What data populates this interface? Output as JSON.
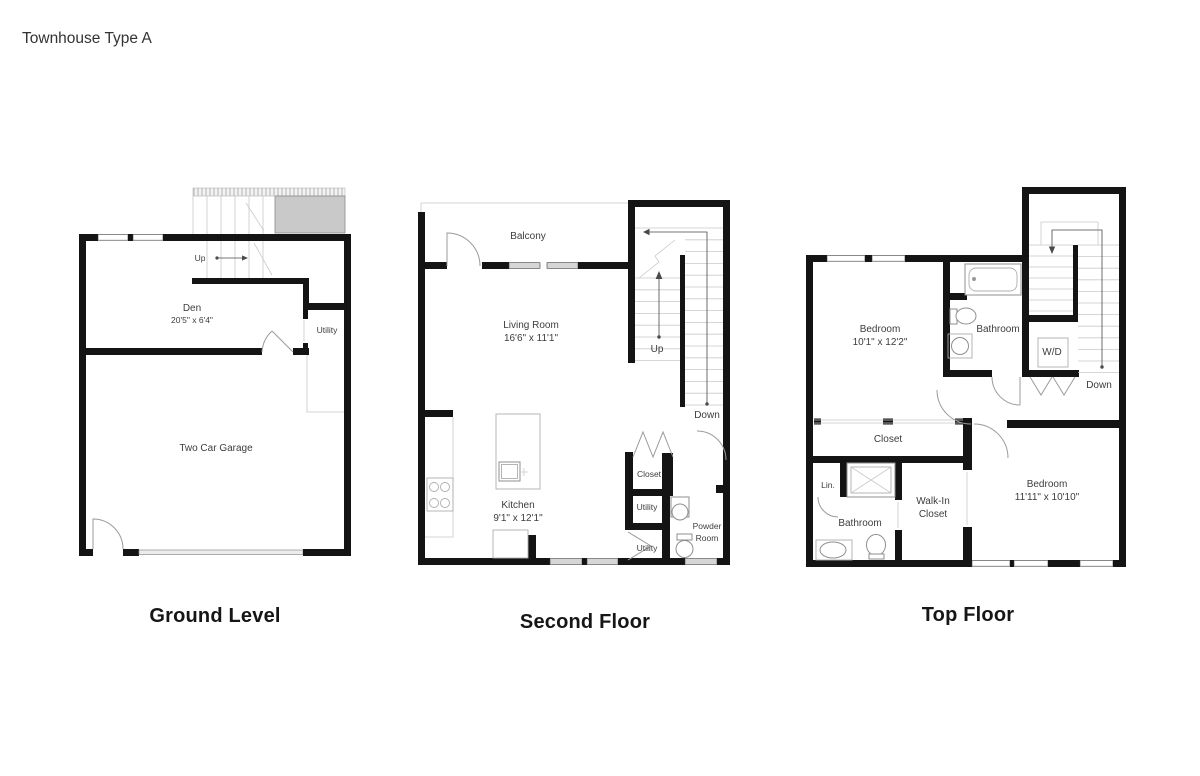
{
  "page_title": "Townhouse Type A",
  "floors": {
    "ground": {
      "title": "Ground Level",
      "labels": {
        "up": "Up",
        "den_name": "Den",
        "den_dims": "20'5\" x 6'4\"",
        "utility": "Utility",
        "garage": "Two Car Garage"
      }
    },
    "second": {
      "title": "Second Floor",
      "labels": {
        "balcony": "Balcony",
        "living_name": "Living Room",
        "living_dims": "16'6\" x 11'1\"",
        "up": "Up",
        "down": "Down",
        "kitchen_name": "Kitchen",
        "kitchen_dims": "9'1\" x 12'1\"",
        "closet": "Closet",
        "utility_upper": "Utility",
        "utility_lower": "Utility",
        "powder_line1": "Powder",
        "powder_line2": "Room"
      }
    },
    "top": {
      "title": "Top Floor",
      "labels": {
        "bedroom1_name": "Bedroom",
        "bedroom1_dims": "10'1\" x 12'2\"",
        "bathroom1": "Bathroom",
        "wd": "W/D",
        "down": "Down",
        "closet": "Closet",
        "linen": "Lin.",
        "bathroom2": "Bathroom",
        "walkin_line1": "Walk-In",
        "walkin_line2": "Closet",
        "bedroom2_name": "Bedroom",
        "bedroom2_dims": "11'11\" x 10'10\""
      }
    }
  }
}
